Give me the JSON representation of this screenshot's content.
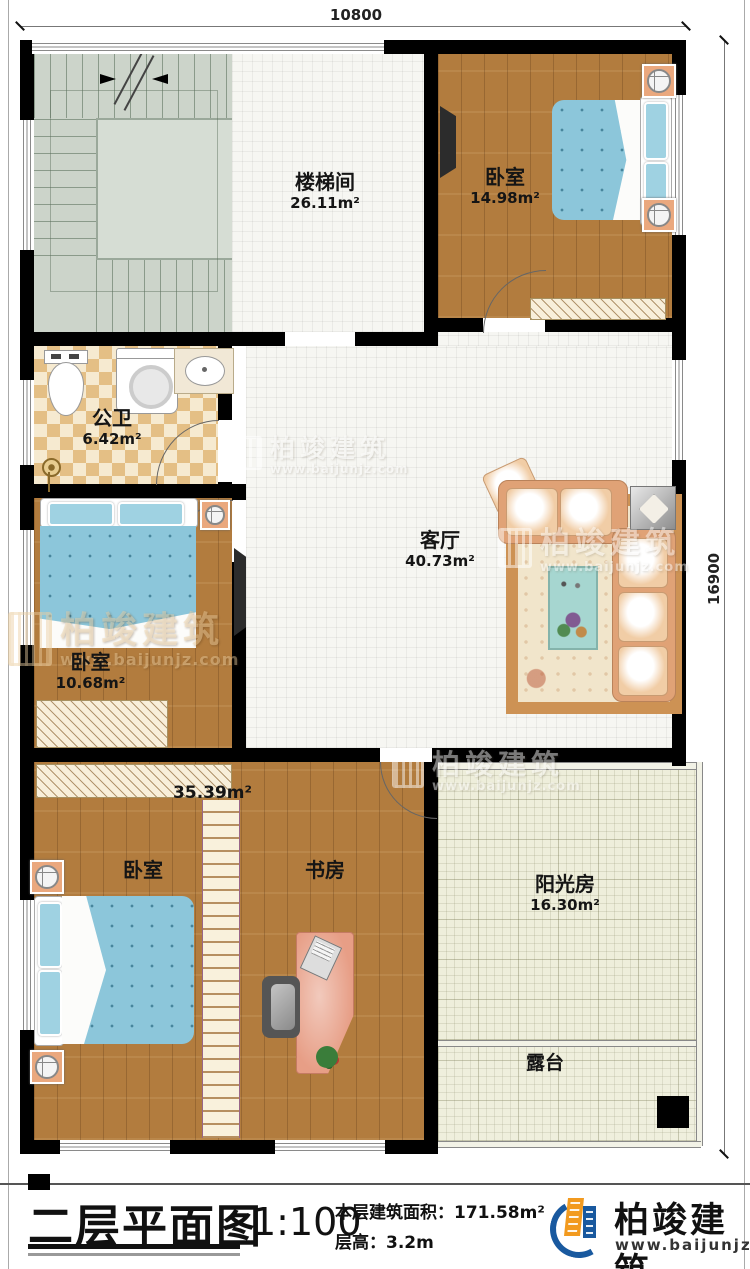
{
  "dimensions": {
    "width_label": "10800",
    "height_label": "16900"
  },
  "rooms": {
    "stairwell": {
      "name": "楼梯间",
      "area": "26.11m²"
    },
    "bedroom_top": {
      "name": "卧室",
      "area": "14.98m²"
    },
    "bathroom": {
      "name": "公卫",
      "area": "6.42m²"
    },
    "living": {
      "name": "客厅",
      "area": "40.73m²"
    },
    "bedroom_mid": {
      "name": "卧室",
      "area": "10.68m²"
    },
    "bedroom_bottom": {
      "name": "卧室",
      "area": "35.39m²"
    },
    "study": {
      "name": "书房"
    },
    "sunroom": {
      "name": "阳光房",
      "area": "16.30m²"
    },
    "terrace": {
      "name": "露台"
    }
  },
  "watermark": {
    "brand": "柏竣建筑",
    "url": "www.baijunjz.com"
  },
  "title_block": {
    "title": "二层平面图",
    "scale": "1:100",
    "area_line": "本层建筑面积：171.58m²",
    "height_line": "层高：3.2m"
  },
  "logo": {
    "brand": "柏竣建筑",
    "url": "www.baijunjz.com"
  }
}
